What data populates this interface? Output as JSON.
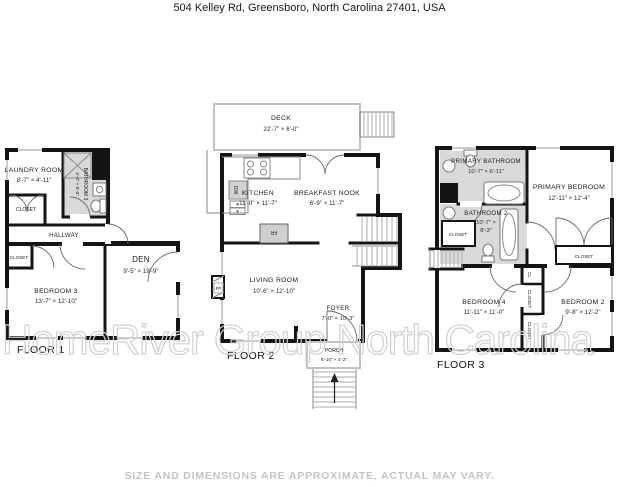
{
  "header": {
    "title": "504 Kelley Rd, Greensboro, North Carolina 27401, USA"
  },
  "watermark": "HomeRiver Group North Carolina",
  "footer": {
    "disclaimer": "SIZE AND DIMENSIONS ARE APPROXIMATE, ACTUAL MAY VARY."
  },
  "palette": {
    "wall": "#141414",
    "bathroom_fill": "#d9d9d9",
    "appliance_fill": "#d2d2d2",
    "stair_line": "#ababab",
    "outdoor_line": "#c2c2c2",
    "watermark_stroke": "#d0d0d0",
    "disclaimer_text": "#c4c4c4"
  },
  "floor1": {
    "label": "FLOOR 1",
    "laundry": {
      "name": "LAUNDRY ROOM",
      "dims": "8'-7\" × 4'-11\""
    },
    "bathroom3": {
      "name": "BATHROOM 3",
      "dims": "4'-9\" × 6'-3\""
    },
    "closet_top": "CLOSET",
    "hallway": "HALLWAY",
    "closet_bottom": "CLOSET",
    "bedroom3": {
      "name": "BEDROOM 3",
      "dims": "13'-7\" × 12'-10\""
    },
    "den": {
      "name": "DEN",
      "dims": "9'-5\" × 19'-9\""
    }
  },
  "floor2": {
    "label": "FLOOR 2",
    "deck": {
      "name": "DECK",
      "dims": "22'-7\" × 6'-0\""
    },
    "kitchen": {
      "name": "KITCHEN",
      "dims": "11'-0\" × 11'-7\""
    },
    "breakfast_nook": {
      "name": "BREAKFAST NOOK",
      "dims": "6'-9\" × 11'-7\""
    },
    "living_room": {
      "name": "LIVING ROOM",
      "dims": "10'-6\" × 12'-10\""
    },
    "foyer": {
      "name": "FOYER",
      "dims": "7'-0\" × 10'-3\""
    },
    "porch": {
      "name": "PORCH",
      "dims": "6'-10\" × 4'-2\""
    },
    "appliances": {
      "dishwasher": "DW",
      "fridge": "FR",
      "fireplace": "FP"
    }
  },
  "floor3": {
    "label": "FLOOR 3",
    "primary_bathroom": {
      "name": "PRIMARY BATHROOM",
      "dims": "10'-7\" × 6'-11\""
    },
    "primary_bedroom": {
      "name": "PRIMARY BEDROOM",
      "dims": "12'-11\" × 12'-4\""
    },
    "bathroom2": {
      "name": "BATHROOM 2",
      "dims1": "10'-7\" ×",
      "dims2": "8'-3\""
    },
    "closet_bath": "CLOSET",
    "closet_primary": "CLOSET",
    "bedroom4": {
      "name": "BEDROOM 4",
      "dims": "11'-11\" × 11'-0\""
    },
    "bedroom2": {
      "name": "BEDROOM 2",
      "dims": "9'-8\" × 12'-2\""
    },
    "cl": "CL",
    "closet_mid1": "CLOSET",
    "closet_mid2": "CLOSET"
  }
}
